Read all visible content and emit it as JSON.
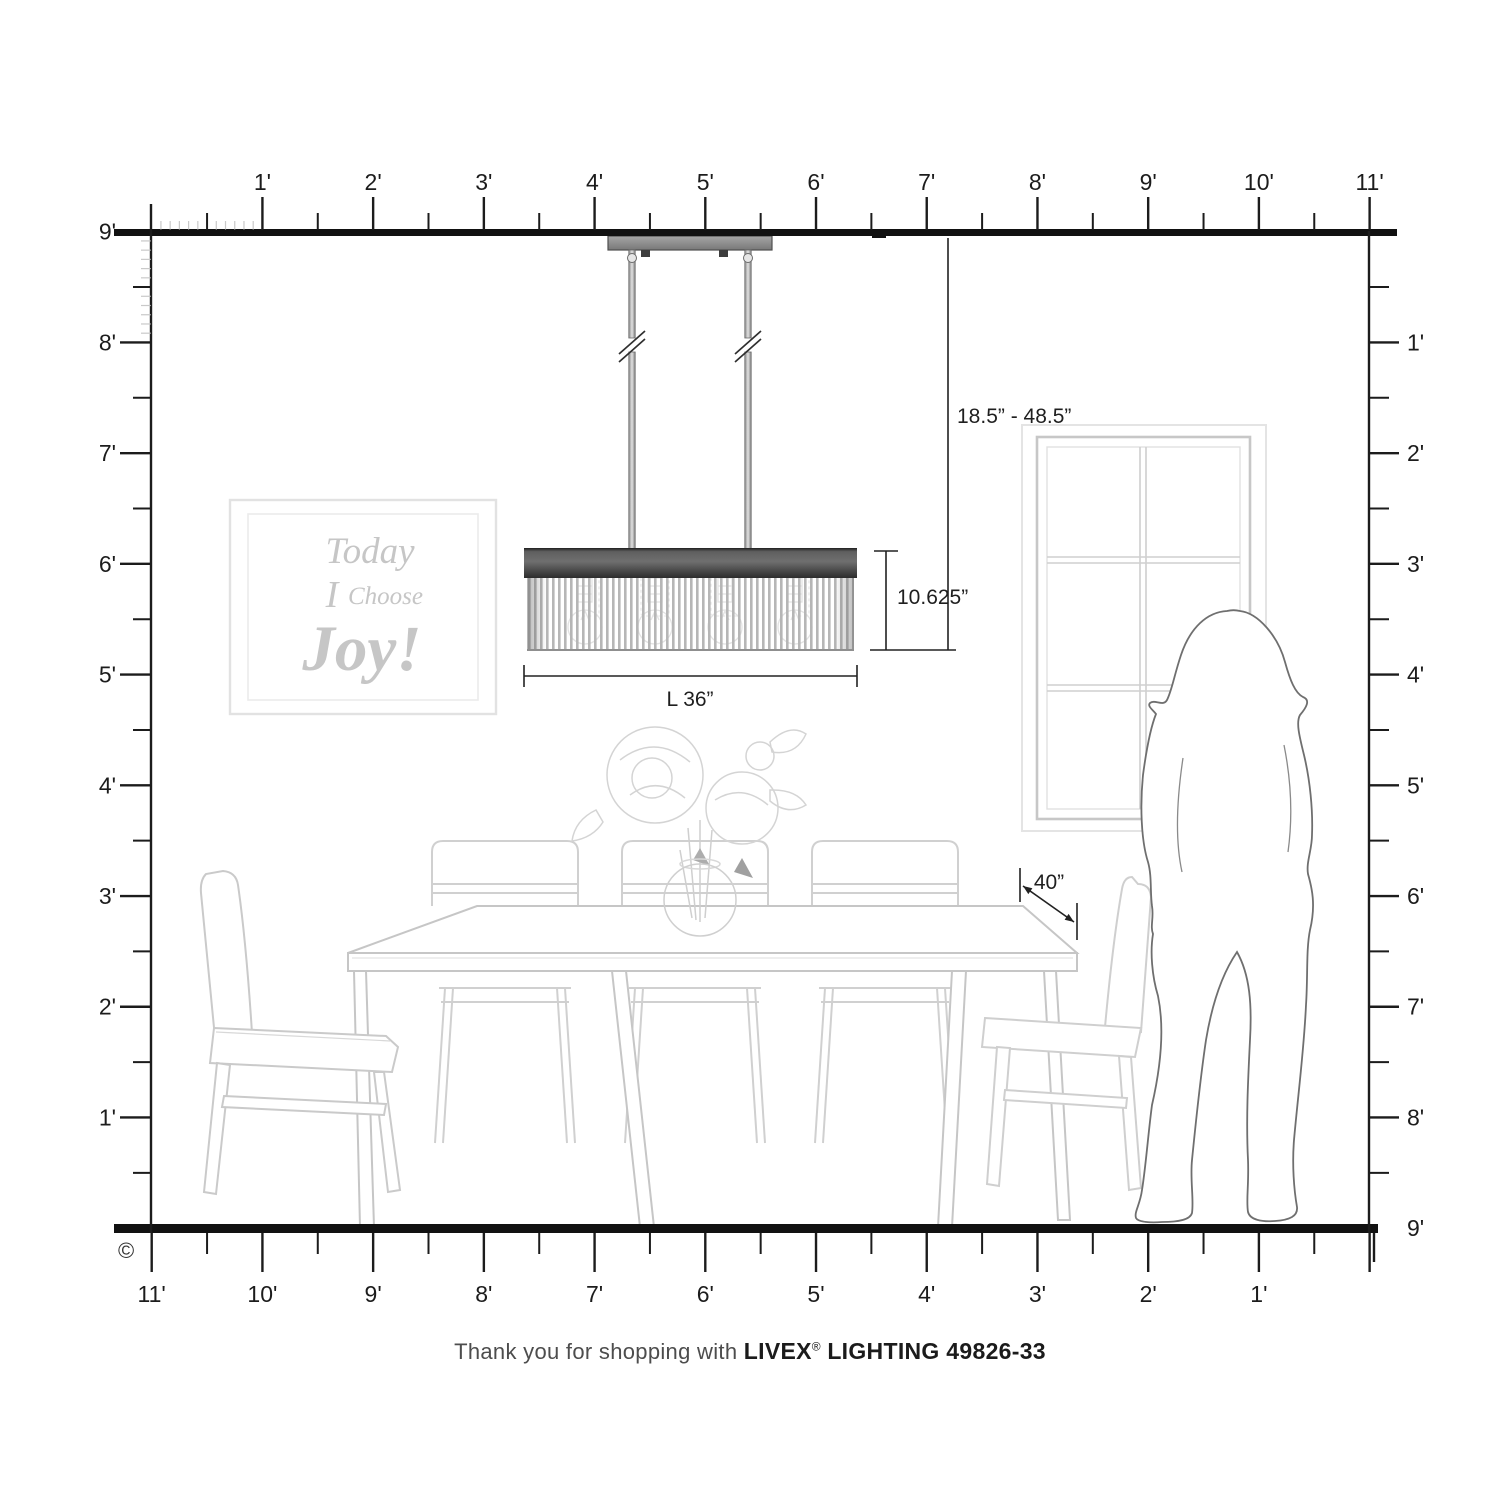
{
  "page": {
    "copyright_symbol": "©"
  },
  "caption": {
    "prefix": "Thank you for shopping with",
    "brand": "LIVEX",
    "registered": "®",
    "model_line": "LIGHTING 49826-33"
  },
  "dimensions": {
    "drop_range": "18.5” - 48.5”",
    "fixture_height": "10.625”",
    "fixture_length": "L 36”",
    "table_clearance": "40”"
  },
  "wall_art": {
    "line1": "Today",
    "line2_a": "I",
    "line2_b": "Choose",
    "line3": "Joy!"
  },
  "rulers": {
    "unit": "feet",
    "top": [
      "1'",
      "2'",
      "3'",
      "4'",
      "5'",
      "6'",
      "7'",
      "8'",
      "9'",
      "10'",
      "11'"
    ],
    "bottom": [
      "11'",
      "10'",
      "9'",
      "8'",
      "7'",
      "6'",
      "5'",
      "4'",
      "3'",
      "2'",
      "1'"
    ],
    "left": [
      "9'",
      "8'",
      "7'",
      "6'",
      "5'",
      "4'",
      "3'",
      "2'",
      "1'"
    ],
    "right": [
      "1'",
      "2'",
      "3'",
      "4'",
      "5'",
      "6'",
      "7'",
      "8'",
      "9'"
    ]
  },
  "colors": {
    "line_black": "#1c1c1c",
    "furniture_gray": "#c9c9c9",
    "silhouette_gray": "#6f6f6f",
    "shade_band_dark": "#3a3a3a",
    "canopy_gray": "#8f8f8f",
    "art_text_gray": "#c6c6c6"
  }
}
